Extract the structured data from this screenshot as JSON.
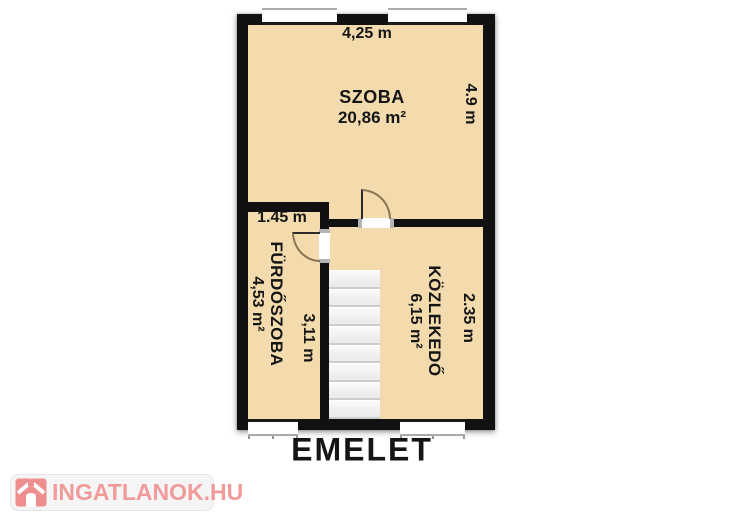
{
  "floor_label": "EMELET",
  "watermark": {
    "text": "INGATLANOK.HU",
    "brand_color": "#f19a9a"
  },
  "plan": {
    "colors": {
      "floor": "#f3dbad",
      "wall": "#111111",
      "stair_fill": "#ededed"
    },
    "rooms": [
      {
        "id": "szoba",
        "name": "SZOBA",
        "area": "20,86 m²"
      },
      {
        "id": "furdoszoba",
        "name": "FÜRDŐSZOBA",
        "area": "4,53 m²"
      },
      {
        "id": "kozlekedo",
        "name": "KÖZLEKEDŐ",
        "area": "6,15 m²"
      }
    ],
    "dimensions": {
      "szoba_width": "4,25 m",
      "szoba_depth": "4.9 m",
      "furdoszoba_width": "1.45 m",
      "furdoszoba_depth": "3,11 m",
      "kozlekedo_depth": "2.35 m"
    },
    "stairs": {
      "steps": 8
    }
  }
}
